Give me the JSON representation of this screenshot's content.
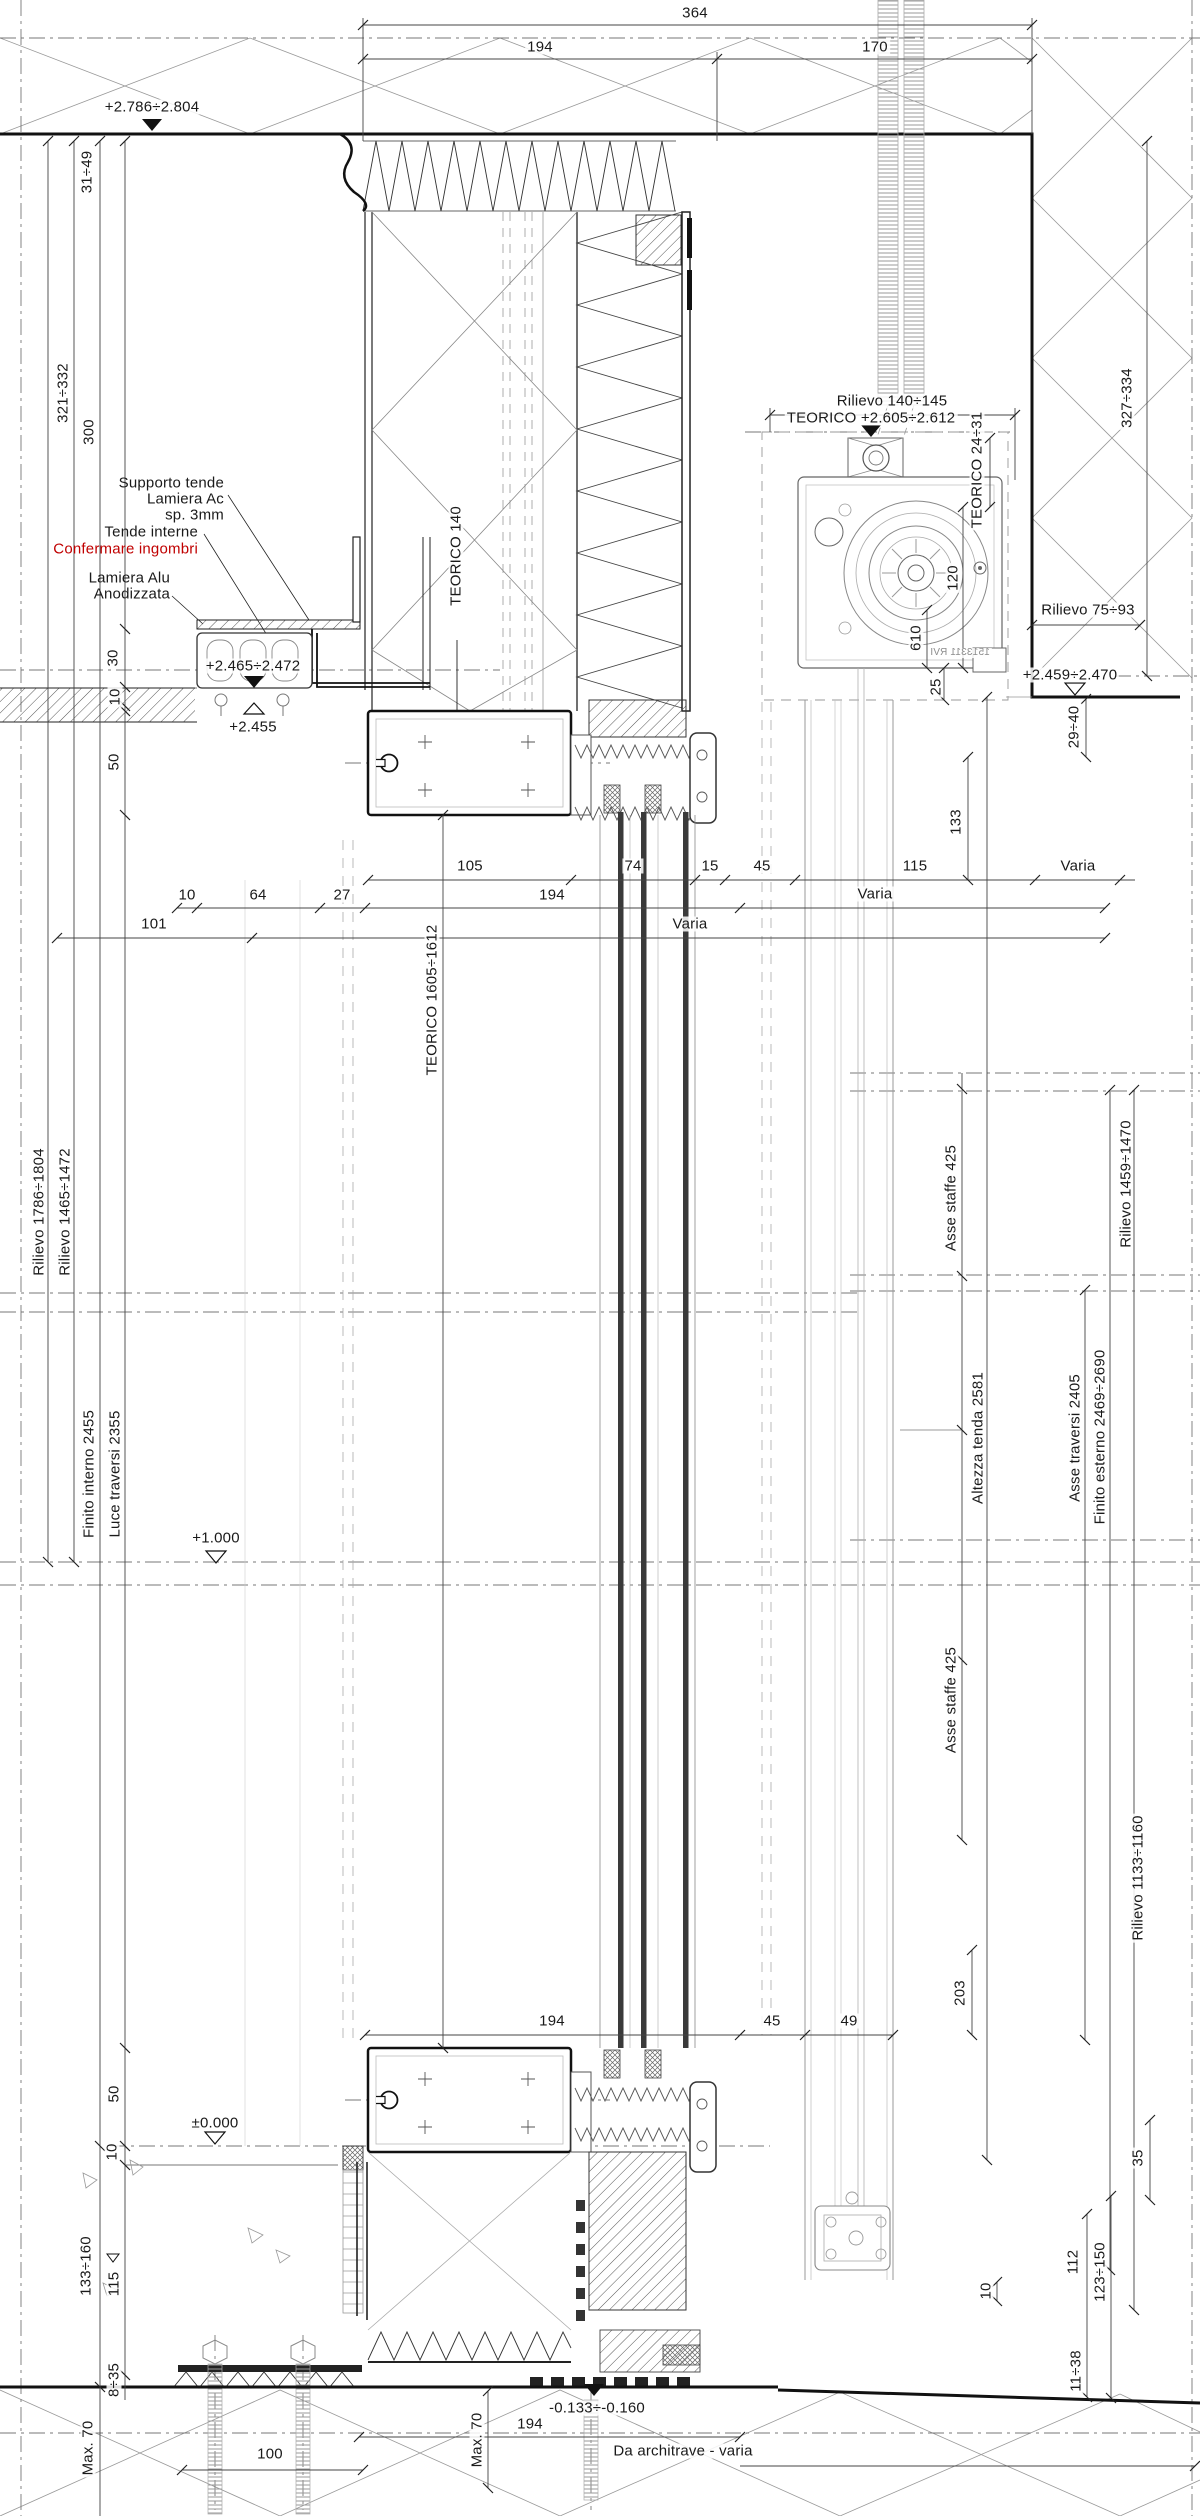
{
  "colors": {
    "red": "#c00000",
    "ink": "#1a1a1a",
    "gray": "#8c8c8c"
  },
  "labels": [
    {
      "n": "dim-total-top",
      "t": "364",
      "x": 695,
      "y": 13
    },
    {
      "n": "dim-top-left",
      "t": "194",
      "x": 540,
      "y": 47
    },
    {
      "n": "dim-top-right",
      "t": "170",
      "x": 875,
      "y": 47
    },
    {
      "n": "level-soffit",
      "t": "+2.786÷2.804",
      "x": 152,
      "y": 107
    },
    {
      "n": "dim-31-49",
      "t": "31÷49",
      "x": 87,
      "y": 172,
      "r": 1
    },
    {
      "n": "dim-321-332",
      "t": "321÷332",
      "x": 63,
      "y": 393,
      "r": 1
    },
    {
      "n": "dim-300",
      "t": "300",
      "x": 89,
      "y": 432,
      "r": 1
    },
    {
      "n": "note-supporto-tende",
      "t": "Supporto tende",
      "x": 226,
      "y": 483,
      "a": "r"
    },
    {
      "n": "note-lamiera-ac",
      "t": "Lamiera Ac",
      "x": 226,
      "y": 499,
      "a": "r"
    },
    {
      "n": "note-sp-3mm",
      "t": "sp. 3mm",
      "x": 226,
      "y": 515,
      "a": "r"
    },
    {
      "n": "note-tende-interne",
      "t": "Tende interne",
      "x": 200,
      "y": 532,
      "a": "r"
    },
    {
      "n": "note-confermare-ingombri",
      "t": "Confermare ingombri",
      "x": 200,
      "y": 549,
      "a": "r",
      "c": "red"
    },
    {
      "n": "note-lamiera-alu",
      "t": "Lamiera Alu",
      "x": 172,
      "y": 578,
      "a": "r"
    },
    {
      "n": "note-anodizzata",
      "t": "Anodizzata",
      "x": 172,
      "y": 594,
      "a": "r"
    },
    {
      "n": "dim-30",
      "t": "30",
      "x": 113,
      "y": 658,
      "r": 1
    },
    {
      "n": "dim-10-ceiling",
      "t": "10",
      "x": 115,
      "y": 697,
      "r": 1
    },
    {
      "n": "level-2465-2472",
      "t": "+2.465÷2.472",
      "x": 253,
      "y": 666
    },
    {
      "n": "level-2455",
      "t": "+2.455",
      "x": 253,
      "y": 727
    },
    {
      "n": "label-teorico-140",
      "t": "TEORICO 140",
      "x": 456,
      "y": 556,
      "r": 1
    },
    {
      "n": "dim-rilievo-140-145",
      "t": "Rilievo 140÷145",
      "x": 892,
      "y": 401
    },
    {
      "n": "level-teorico-2605-2612",
      "t": "TEORICO +2.605÷2.612",
      "x": 871,
      "y": 418
    },
    {
      "n": "dim-teorico-24-31",
      "t": "TEORICO 24÷31",
      "x": 977,
      "y": 470,
      "r": 1
    },
    {
      "n": "dim-120",
      "t": "120",
      "x": 953,
      "y": 578,
      "r": 1
    },
    {
      "n": "part-number",
      "t": "1513311 RVI",
      "x": 960,
      "y": 653,
      "flip": 1,
      "c": "gray",
      "fs": 10
    },
    {
      "n": "dim-327-334",
      "t": "327÷334",
      "x": 1127,
      "y": 398,
      "r": 1
    },
    {
      "n": "dim-rilievo-75-93",
      "t": "Rilievo 75÷93",
      "x": 1088,
      "y": 610
    },
    {
      "n": "level-2459-2470",
      "t": "+2.459÷2.470",
      "x": 1070,
      "y": 675
    },
    {
      "n": "dim-610",
      "t": "610",
      "x": 916,
      "y": 638,
      "r": 1
    },
    {
      "n": "dim-25",
      "t": "25",
      "x": 936,
      "y": 687,
      "r": 1
    },
    {
      "n": "dim-29-40",
      "t": "29÷40",
      "x": 1074,
      "y": 727,
      "r": 1
    },
    {
      "n": "dim-133",
      "t": "133",
      "x": 956,
      "y": 822,
      "r": 1
    },
    {
      "n": "dim-50-top",
      "t": "50",
      "x": 114,
      "y": 762,
      "r": 1
    },
    {
      "n": "dim-105",
      "t": "105",
      "x": 470,
      "y": 866
    },
    {
      "n": "dim-74",
      "t": "74",
      "x": 633,
      "y": 866
    },
    {
      "n": "dim-15",
      "t": "15",
      "x": 710,
      "y": 866
    },
    {
      "n": "dim-45-mid",
      "t": "45",
      "x": 762,
      "y": 866
    },
    {
      "n": "dim-115",
      "t": "115",
      "x": 915,
      "y": 866
    },
    {
      "n": "dim-varia-1",
      "t": "Varia",
      "x": 1078,
      "y": 866
    },
    {
      "n": "dim-10-row2",
      "t": "10",
      "x": 187,
      "y": 895
    },
    {
      "n": "dim-64",
      "t": "64",
      "x": 258,
      "y": 895
    },
    {
      "n": "dim-27",
      "t": "27",
      "x": 342,
      "y": 895
    },
    {
      "n": "dim-194-mid",
      "t": "194",
      "x": 552,
      "y": 895
    },
    {
      "n": "dim-varia-2",
      "t": "Varia",
      "x": 875,
      "y": 894
    },
    {
      "n": "dim-101",
      "t": "101",
      "x": 154,
      "y": 924
    },
    {
      "n": "dim-varia-3",
      "t": "Varia",
      "x": 690,
      "y": 924
    },
    {
      "n": "label-teorico-1605-1612",
      "t": "TEORICO 1605÷1612",
      "x": 432,
      "y": 1000,
      "r": 1
    },
    {
      "n": "dim-rilievo-1786-1804",
      "t": "Rilievo 1786÷1804",
      "x": 39,
      "y": 1212,
      "r": 1
    },
    {
      "n": "dim-rilievo-1465-1472",
      "t": "Rilievo 1465÷1472",
      "x": 65,
      "y": 1212,
      "r": 1
    },
    {
      "n": "dim-asse-staffe-425-a",
      "t": "Asse staffe 425",
      "x": 951,
      "y": 1198,
      "r": 1
    },
    {
      "n": "dim-rilievo-1459-1470",
      "t": "Rilievo 1459÷1470",
      "x": 1126,
      "y": 1184,
      "r": 1
    },
    {
      "n": "dim-finito-interno-2455",
      "t": "Finito interno 2455",
      "x": 89,
      "y": 1474,
      "r": 1
    },
    {
      "n": "dim-luce-traversi-2355",
      "t": "Luce traversi 2355",
      "x": 115,
      "y": 1474,
      "r": 1
    },
    {
      "n": "level-1000",
      "t": "+1.000",
      "x": 216,
      "y": 1538
    },
    {
      "n": "dim-altezza-tenda-2581",
      "t": "Altezza tenda 2581",
      "x": 978,
      "y": 1438,
      "r": 1
    },
    {
      "n": "dim-asse-traversi-2405",
      "t": "Asse traversi 2405",
      "x": 1075,
      "y": 1438,
      "r": 1
    },
    {
      "n": "dim-finito-esterno",
      "t": "Finito esterno 2469÷2690",
      "x": 1100,
      "y": 1437,
      "r": 1
    },
    {
      "n": "dim-asse-staffe-425-b",
      "t": "Asse staffe 425",
      "x": 951,
      "y": 1700,
      "r": 1
    },
    {
      "n": "dim-rilievo-1133-1160",
      "t": "Rilievo 1133÷1160",
      "x": 1138,
      "y": 1878,
      "r": 1
    },
    {
      "n": "dim-203",
      "t": "203",
      "x": 960,
      "y": 1993,
      "r": 1
    },
    {
      "n": "dim-194-low",
      "t": "194",
      "x": 552,
      "y": 2021
    },
    {
      "n": "dim-45-low",
      "t": "45",
      "x": 772,
      "y": 2021
    },
    {
      "n": "dim-49",
      "t": "49",
      "x": 849,
      "y": 2021
    },
    {
      "n": "dim-35",
      "t": "35",
      "x": 1138,
      "y": 2158,
      "r": 1
    },
    {
      "n": "dim-10-guide",
      "t": "10",
      "x": 986,
      "y": 2291,
      "r": 1
    },
    {
      "n": "dim-50-low",
      "t": "50",
      "x": 114,
      "y": 2094,
      "r": 1
    },
    {
      "n": "level-0000",
      "t": "±0.000",
      "x": 215,
      "y": 2123
    },
    {
      "n": "dim-10-floor",
      "t": "10",
      "x": 112,
      "y": 2152,
      "r": 1
    },
    {
      "n": "dim-133-160",
      "t": "133÷160",
      "x": 86,
      "y": 2266,
      "r": 1
    },
    {
      "n": "dim-115-low",
      "t": "115",
      "x": 114,
      "y": 2284,
      "r": 1
    },
    {
      "n": "dim-8-35",
      "t": "8÷35",
      "x": 114,
      "y": 2380,
      "r": 1
    },
    {
      "n": "dim-max-70-left",
      "t": "Max. 70",
      "x": 88,
      "y": 2448,
      "r": 1
    },
    {
      "n": "dim-100",
      "t": "100",
      "x": 270,
      "y": 2454
    },
    {
      "n": "level-minus-0133-0160",
      "t": "-0.133÷-0.160",
      "x": 597,
      "y": 2408
    },
    {
      "n": "dim-max-70-mid",
      "t": "Max. 70",
      "x": 477,
      "y": 2440,
      "r": 1
    },
    {
      "n": "dim-194-bottom",
      "t": "194",
      "x": 530,
      "y": 2424
    },
    {
      "n": "note-da-architrave",
      "t": "Da architrave - varia",
      "x": 683,
      "y": 2451
    },
    {
      "n": "dim-112",
      "t": "112",
      "x": 1073,
      "y": 2262,
      "r": 1
    },
    {
      "n": "dim-123-150",
      "t": "123÷150",
      "x": 1100,
      "y": 2272,
      "r": 1
    },
    {
      "n": "dim-11-38",
      "t": "11÷38",
      "x": 1076,
      "y": 2371,
      "r": 1
    }
  ]
}
